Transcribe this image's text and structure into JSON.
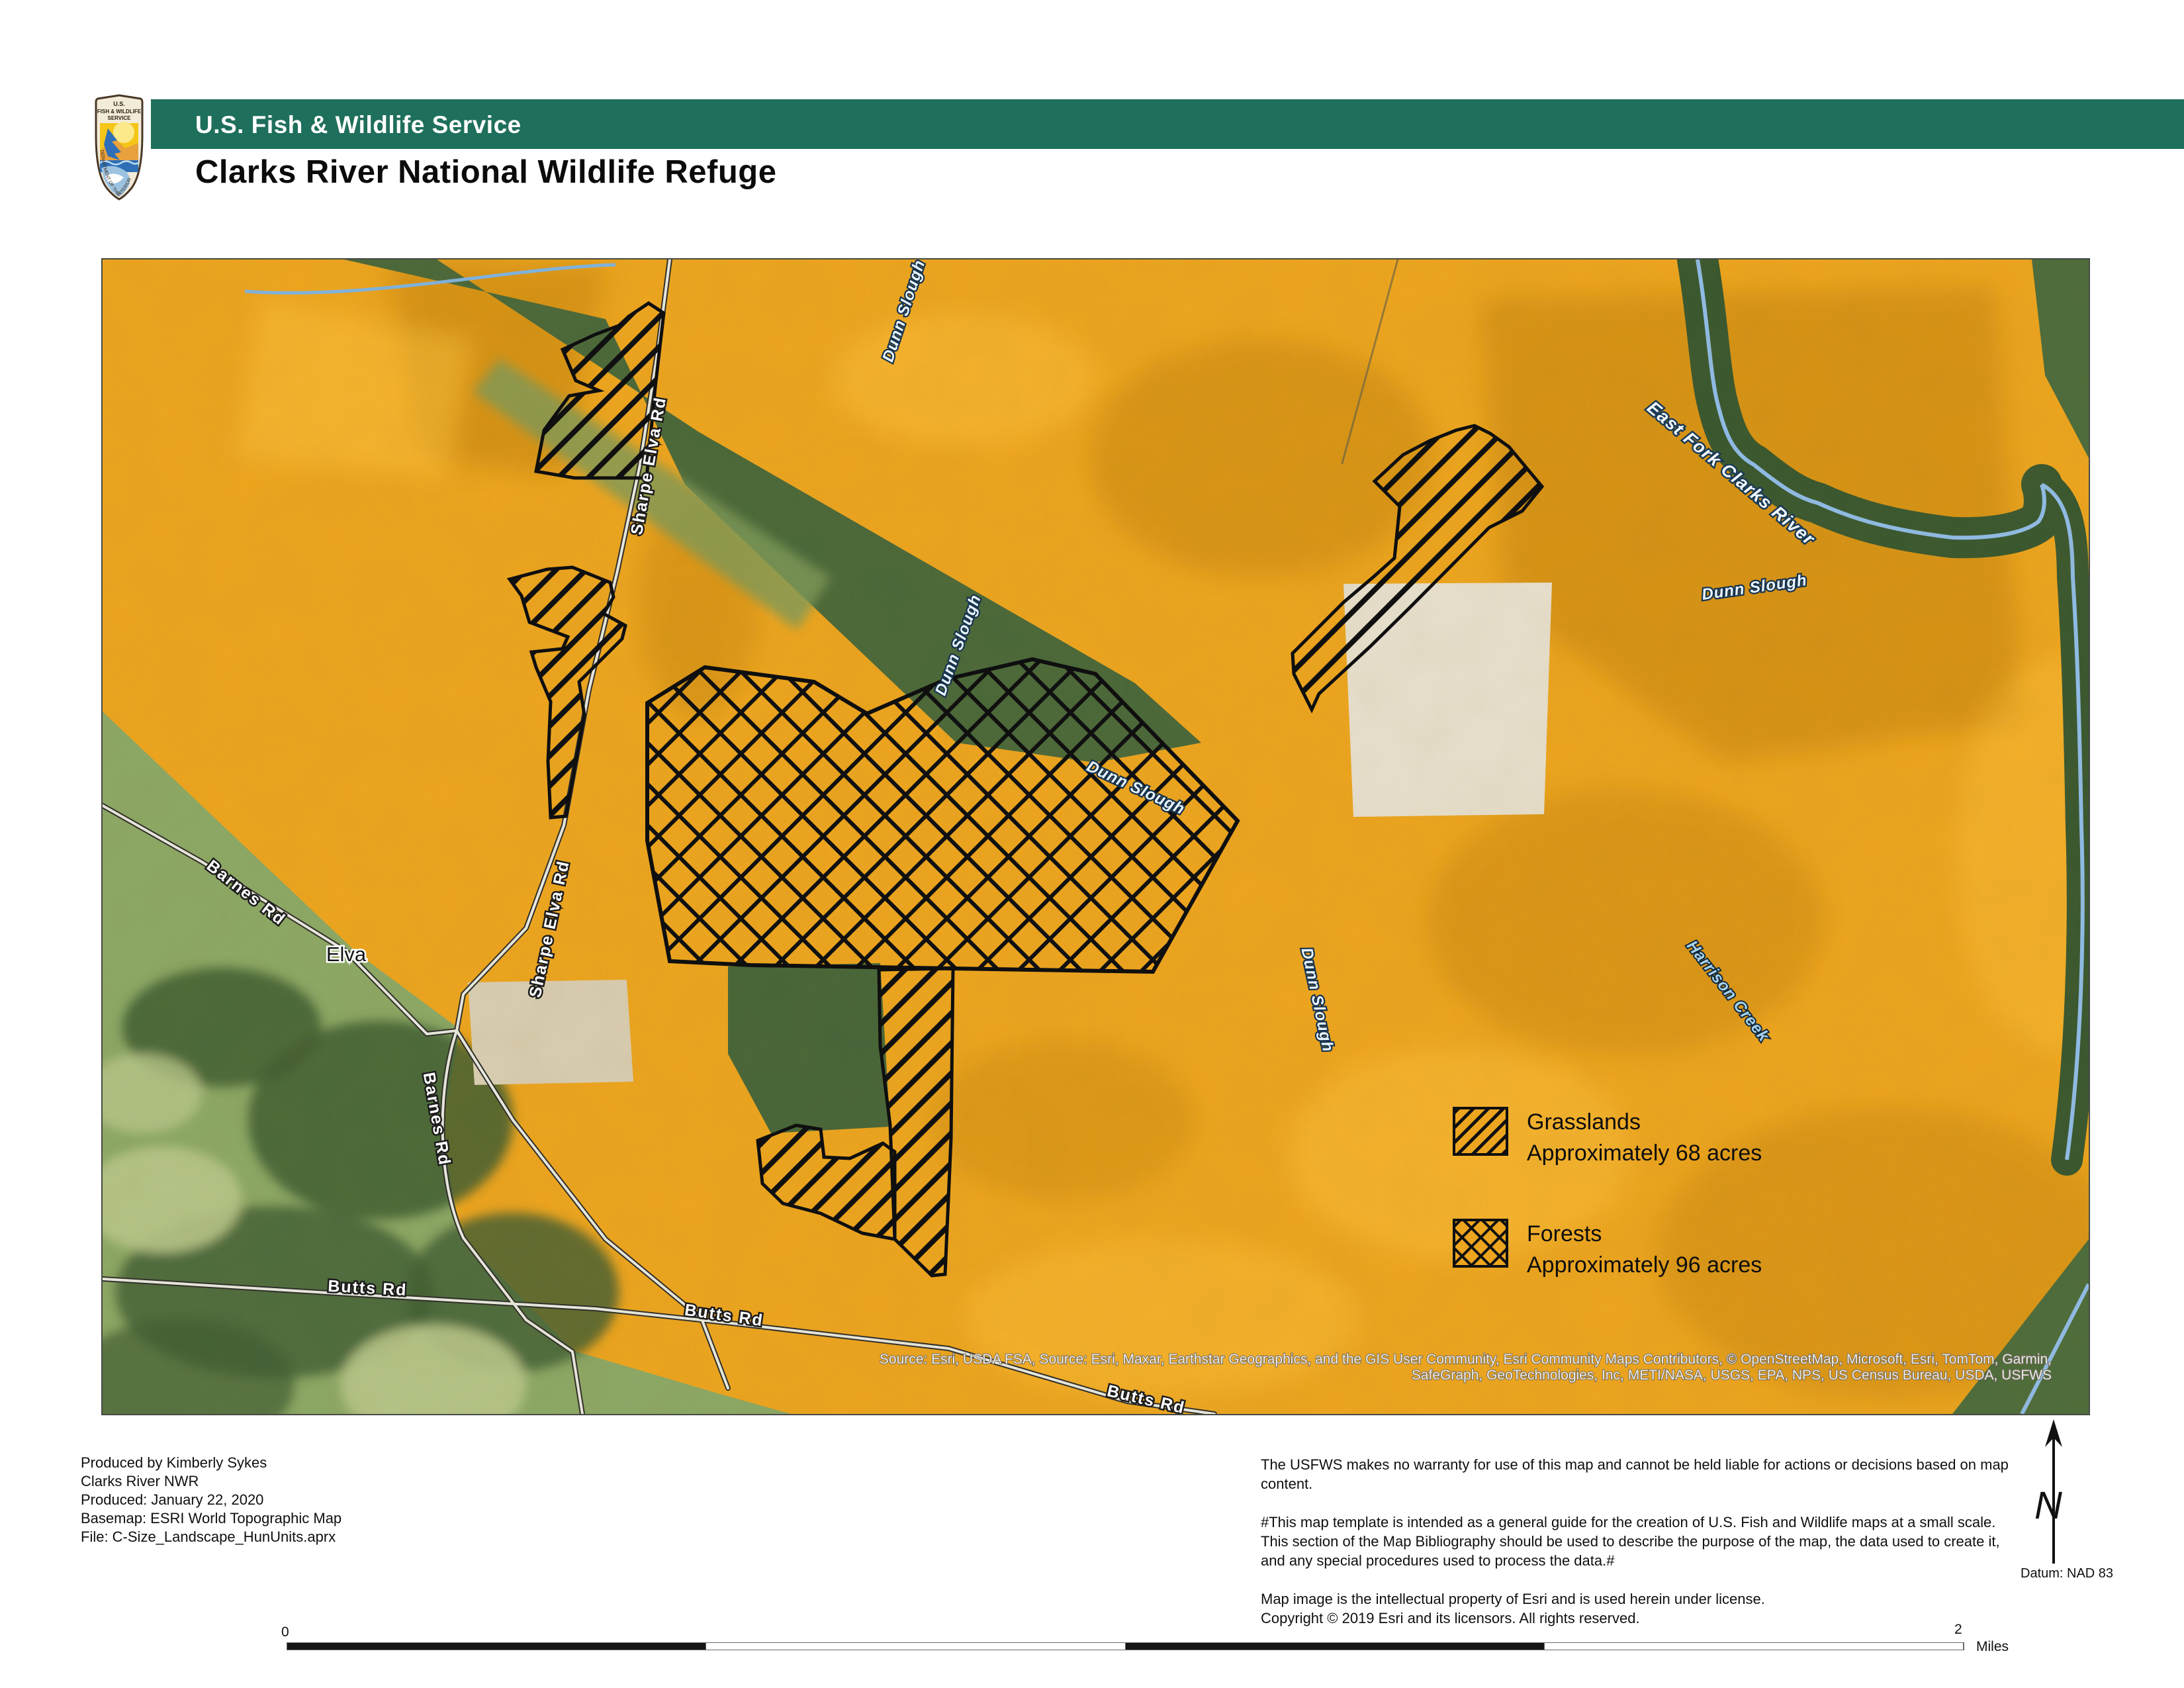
{
  "header": {
    "agency_banner": "U.S. Fish & Wildlife Service",
    "map_title": "Clarks River National Wildlife Refuge",
    "logo": {
      "line1": "U.S.",
      "line2": "FISH & WILDLIFE",
      "line3": "SERVICE",
      "arc_text": "DEPARTMENT OF THE INTERIOR"
    }
  },
  "map": {
    "place_labels": [
      "Elva"
    ],
    "road_labels": [
      "Sharpe Elva Rd",
      "Sharpe Elva Rd",
      "Barnes Rd",
      "Barnes Rd",
      "Butts Rd",
      "Butts Rd",
      "Butts Rd"
    ],
    "water_labels": [
      "Dunn Slough",
      "Dunn Slough",
      "Dunn Slough",
      "Dunn Slough",
      "Dunn Slough",
      "East Fork Clarks River",
      "Harrison Creek"
    ],
    "attribution_line1": "Source: Esri, USDA FSA, Source: Esri, Maxar, Earthstar Geographics, and the GIS User Community, Esri Community Maps Contributors, © OpenStreetMap, Microsoft, Esri, TomTom, Garmin,",
    "attribution_line2": "SafeGraph, GeoTechnologies, Inc, METI/NASA, USGS, EPA, NPS, US Census Bureau, USDA, USFWS"
  },
  "legend": {
    "entries": [
      {
        "name": "Grasslands",
        "detail": "Approximately 68 acres",
        "pattern": "diagonal-hatch"
      },
      {
        "name": "Forests",
        "detail": "Approximately 96 acres",
        "pattern": "cross-hatch"
      }
    ]
  },
  "scale_bar": {
    "start_label": "0",
    "end_label": "2",
    "unit_label": "Miles"
  },
  "north_arrow": {
    "letter": "N"
  },
  "datum_note": "Datum: NAD 83",
  "footer": {
    "left_lines": [
      "Produced by Kimberly Sykes",
      "Clarks River NWR",
      "Produced: January 22, 2020",
      "Basemap: ESRI World Topographic Map",
      "File: C-Size_Landscape_HunUnits.aprx"
    ],
    "right_paragraph1": "The USFWS makes no warranty for use of this map and cannot be held liable for actions or decisions based on map content.",
    "right_paragraph2_lines": [
      "#This map template is intended as a general guide for the creation of U.S. Fish and Wildlife maps at a small scale.",
      "This section of the Map Bibliography should be used to describe the purpose of the map, the data used to create it,",
      "and any special procedures used to process the data.#"
    ],
    "right_paragraph3_lines": [
      "Map image is the intellectual property of Esri and is used herein under license.",
      "Copyright © 2019 Esri and its licensors. All rights reserved."
    ]
  },
  "colors": {
    "banner_green": "#1E6F5B",
    "refuge_orange": "#EDA51F",
    "water_blue": "#8FBCE8",
    "hatch_black": "#111111"
  }
}
